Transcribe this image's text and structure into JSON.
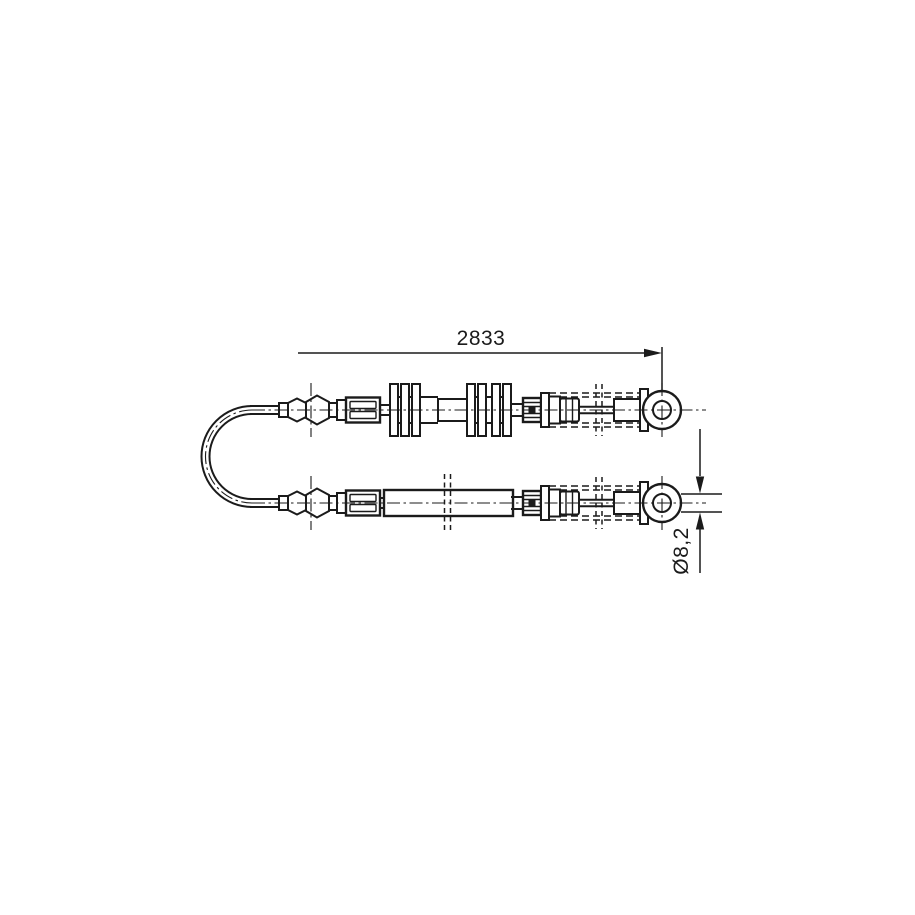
{
  "drawing": {
    "labels": {
      "length": "2833",
      "diameter": "Ø8,2"
    },
    "colors": {
      "background": "#ffffff",
      "line": "#1b1b1b"
    }
  }
}
